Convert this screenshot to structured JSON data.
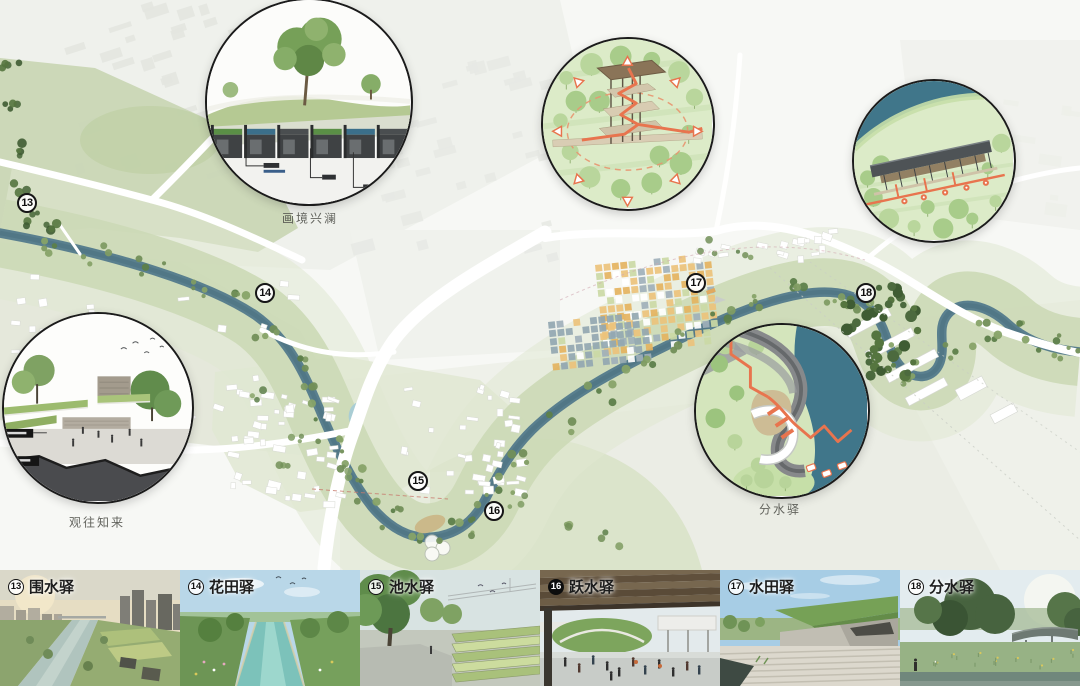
{
  "map": {
    "badges": [
      "13",
      "14",
      "15",
      "16",
      "17",
      "18"
    ],
    "captions": {
      "top_circle": "画境兴澜",
      "left_circle": "观往知来",
      "right_circle": "分水驿"
    }
  },
  "legend": {
    "items": [
      {
        "num": "13",
        "name": "围水驿"
      },
      {
        "num": "14",
        "name": "花田驿"
      },
      {
        "num": "15",
        "name": "池水驿"
      },
      {
        "num": "16",
        "name": "跃水驿"
      },
      {
        "num": "17",
        "name": "水田驿"
      },
      {
        "num": "18",
        "name": "分水驿"
      }
    ]
  },
  "colors": {
    "river_teal": "#567f8e",
    "deep_water": "#40768a",
    "corridor_green": "#ccd9b6",
    "callout_green": "#dcebc8",
    "accent_orange": "#e8744e"
  }
}
